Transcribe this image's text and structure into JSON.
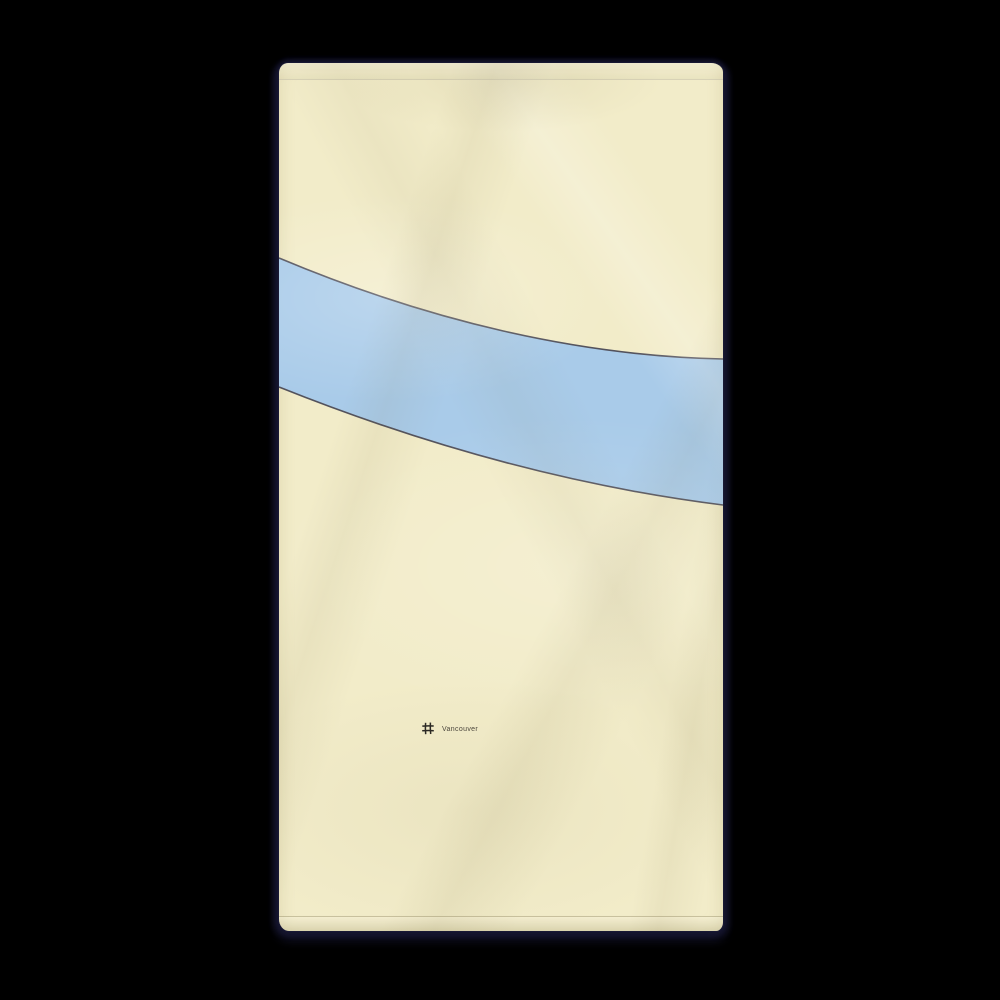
{
  "photo": {
    "subject": "beach towel product mockup",
    "background_color": "#000000"
  },
  "towel": {
    "brand_label": "Vancouver",
    "logo_icon": "grid-hash-icon",
    "design": "minimal map print with water band"
  },
  "colors": {
    "background": "#000000",
    "towel_cream": "#f2ecc9",
    "river_blue": "#a9cbe9",
    "river_outline": "#53525c",
    "shadow_navy": "#16162f",
    "brand_text": "#4b463c",
    "hash_icon": "#2b2924"
  }
}
